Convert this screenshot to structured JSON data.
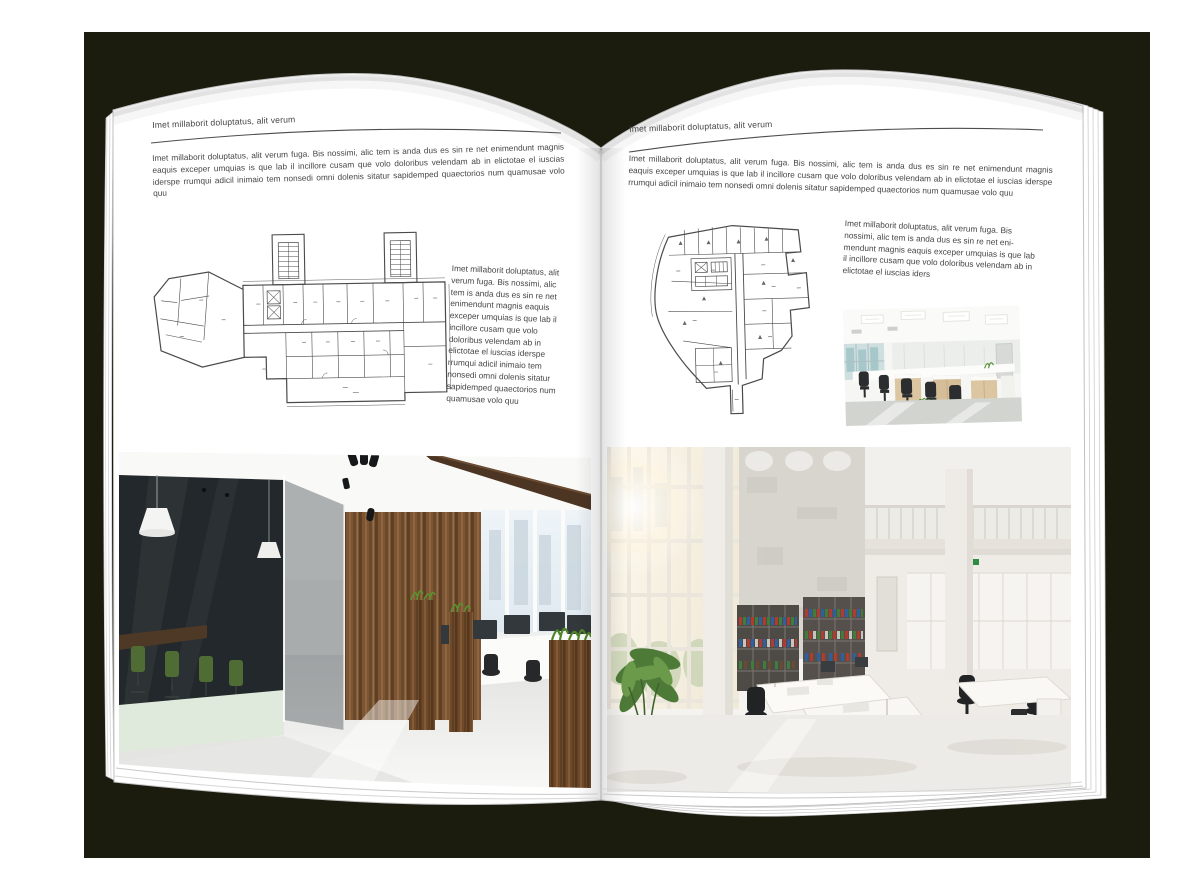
{
  "colors": {
    "backdrop": "#1b1c0e",
    "page": "#ffffff",
    "text": "#454545",
    "rule": "#4d4d4d",
    "plan_line": "#4a4a4a",
    "wood": "#7c5634",
    "leaf_green": "#5a8f2e",
    "chair_green": "#4f6c34",
    "chair_black": "#26282a",
    "window_blue": "#dfe9f0",
    "concrete": "#d8d5cf",
    "binder_red": "#b23b30",
    "binder_green": "#3f7d3a",
    "binder_blue": "#2f5f9e"
  },
  "left_page": {
    "header": "Imet millaborit doluptatus, alit verum",
    "intro": "Imet millaborit doluptatus, alit verum fuga. Bis nossimi, alic tem is anda dus es sin re net enimendunt magnis eaquis exceper umquias is que lab il incillore cusam que volo doloribus velendam ab in elictotae el iuscias iderspe rrumqui adicil inimaio tem nonsedi omni dolenis sitatur sapidemped quaectorios num quamusae volo quu",
    "side_text": "Imet millaborit doluptatus, alit verum fuga. Bis nossimi, alic tem is anda dus es sin re net enimendunt magnis eaquis exceper umquias is que lab il incillore cusam que volo doloribus velendam ab in elictotae el iuscias iderspe rrumqui adicil inimaio tem nonsedi omni dolenis sitatur sapidemped quaectorios num quamusae volo quu"
  },
  "right_page": {
    "header": "Imet millaborit doluptatus, alit verum",
    "intro": "Imet millaborit doluptatus, alit verum fuga. Bis nossimi, alic tem is anda dus es sin re net enimendunt magnis eaquis exceper umquias is que lab il incillore cusam que volo doloribus velendam ab in elictotae el iuscias iderspe rrumqui adicil inimaio tem nonsedi omni dolenis sitatur sapidemped quaectorios num quamusae volo quu",
    "side_text": "Imet millaborit doluptatus, alit verum fuga. Bis nossimi, alic tem is anda dus es sin re net eni-mendunt magnis eaquis exceper umquias is que lab il incillore cusam que volo doloribus velendam ab in elictotae el iuscias iders"
  }
}
